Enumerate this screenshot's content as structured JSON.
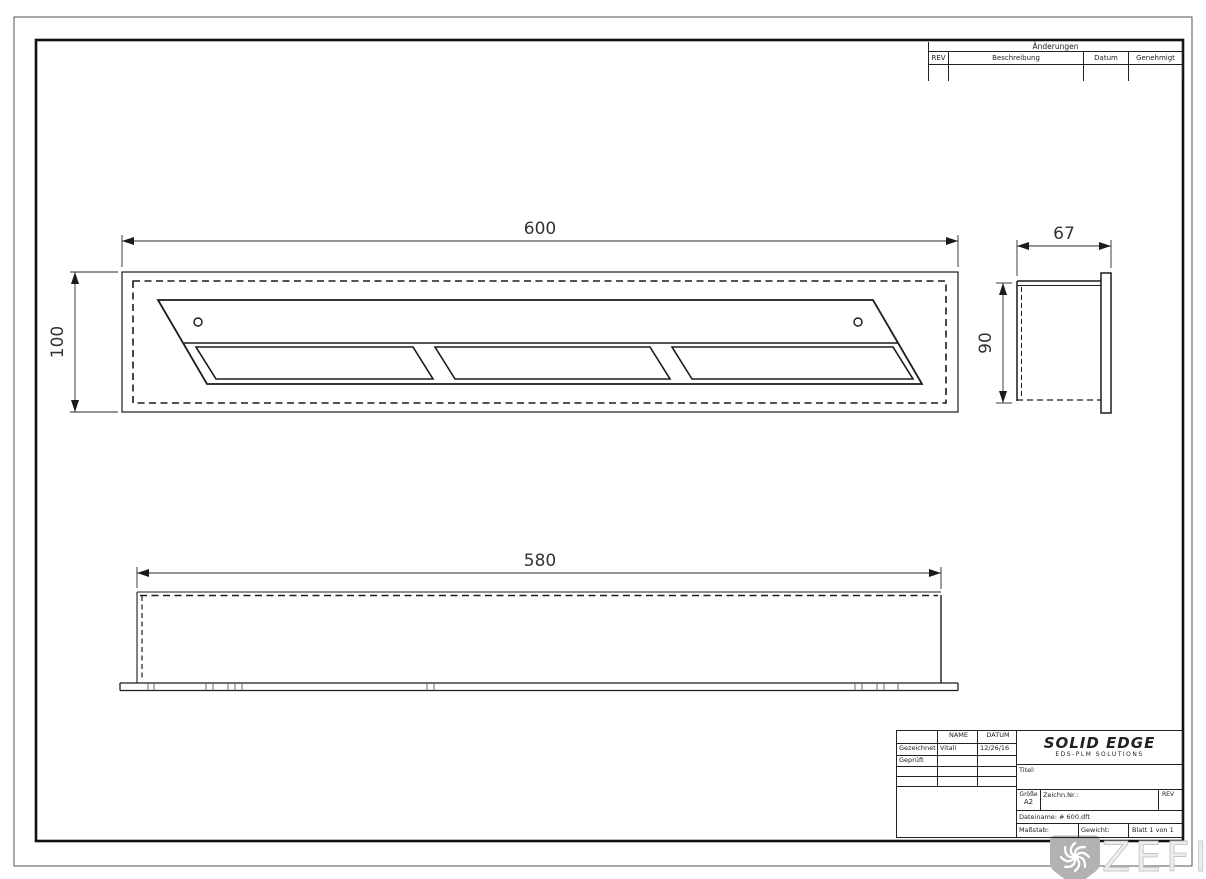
{
  "page": {
    "watermark_text": "ZEFIRE",
    "colors": {
      "line": "#1b1b1b",
      "watermark_badge": "#b2b2b2",
      "watermark_text": "#ededed"
    }
  },
  "dimensions": {
    "top_width": "600",
    "top_height": "100",
    "side_depth": "67",
    "side_height": "90",
    "front_width": "580"
  },
  "revision_table": {
    "title": "Änderungen",
    "columns": [
      "REV",
      "Beschreibung",
      "Datum",
      "Genehmigt"
    ]
  },
  "title_block": {
    "header": {
      "name": "NAME",
      "datum": "DATUM"
    },
    "rows": [
      {
        "label": "Gezeichnet",
        "name": "Vitali",
        "date": "12/26/16"
      },
      {
        "label": "Geprüft",
        "name": "",
        "date": ""
      }
    ],
    "logo": {
      "main": "SOLID EDGE",
      "sub": "EDS-PLM SOLUTIONS"
    },
    "titel_label": "Titel:",
    "size_label": "Größe",
    "size_value": "A2",
    "drawing_no_label": "Zeichn.Nr.:",
    "rev_label": "REV",
    "filename_label": "Dateiname: # 600.dft",
    "scale_label": "Maßstab:",
    "weight_label": "Gewicht:",
    "sheet_label": "Blatt 1 von 1"
  }
}
